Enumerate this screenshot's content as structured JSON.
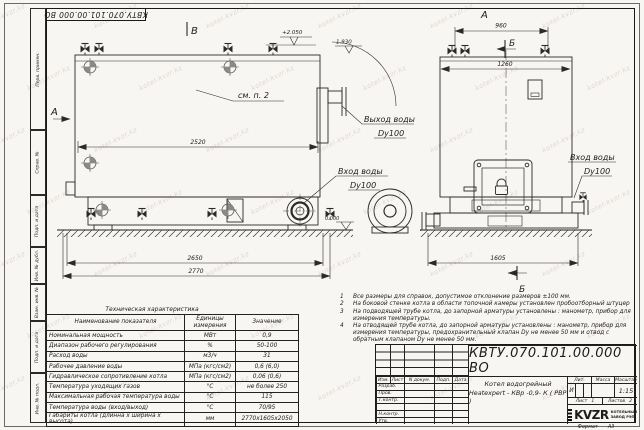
{
  "watermark": {
    "text": "kotel-kvzr.kz"
  },
  "sheet": {
    "stamp_top": "КВТУ.070.101.00.000 ВО",
    "margin_labels": [
      "Перв. примен.",
      "Справ. №",
      "Подп. и дата",
      "Инв. № дубл.",
      "Взам. инв. №",
      "Подп. и дата",
      "Инв. № подл."
    ],
    "format_label": "Формат",
    "format_value": "А3"
  },
  "views": {
    "label_v": "В",
    "label_a_side": "А",
    "label_a_top": "А",
    "label_b_top": "Б",
    "label_b_bottom": "Б",
    "see_note": "см. п. 2",
    "elev_top": "+2.050",
    "elev_outlet": "1.930",
    "elev_zero": "0.000",
    "dim_2520": "2520",
    "dim_2650": "2650",
    "dim_2770": "2770",
    "dim_960": "960",
    "dim_1260": "1260",
    "dim_1605": "1605",
    "outlet_line1": "Выход воды",
    "outlet_line2": "Dy100",
    "inlet1_line1": "Вход воды",
    "inlet1_line2": "Dy100",
    "inlet2_line1": "Вход воды",
    "inlet2_line2": "Dy100"
  },
  "tech_table": {
    "title": "Техническая характеристика",
    "headers": [
      "Наименование показателя",
      "Единицы измерения",
      "Значение"
    ],
    "rows": [
      [
        "Номинальная мощность",
        "МВт",
        "0,9"
      ],
      [
        "Диапазон рабочего регулирования",
        "%",
        "50-100"
      ],
      [
        "Расход воды",
        "м3/ч",
        "31"
      ],
      [
        "Рабочее давление воды",
        "МПа (кгс/см2)",
        "0,6 (6,0)"
      ],
      [
        "Гидравлическое сопротивление котла",
        "МПа (кгс/см2)",
        "0,06 (0,6)"
      ],
      [
        "Температура уходящих газов",
        "°С",
        "не более 250"
      ],
      [
        "Максимальная рабочая температура воды",
        "°С",
        "115"
      ],
      [
        "Температура воды (вход/выход)",
        "°С",
        "70/95"
      ],
      [
        "Габариты котла (длинна х ширина х высота)",
        "мм",
        "2770х1605х2050"
      ]
    ]
  },
  "notes": {
    "items": [
      {
        "num": "1",
        "text": "Все размеры для справок, допустимое отклонение размеров ±100 мм."
      },
      {
        "num": "2",
        "text": "На боковой стенке котла в области топочной камеры установлен пробоотборный штуцер"
      },
      {
        "num": "3",
        "text": "На  подводящей трубе котла, до запорной арматуры установлены : манометр, прибор для измерения температуры."
      },
      {
        "num": "4",
        "text": "На отводящей трубе котла, до запорной арматуры установлены : манометр, прибор для измерения температуры, предохранительный клапан  Dу не менее  50 мм и отвод с обратным клапаном  Dу не менее  50 мм."
      }
    ]
  },
  "title_block": {
    "designation": "КВТУ.070.101.00.000  ВО",
    "name_line1": "Котел водогрейный",
    "name_line2": "Heatexpert - КВр -0,9- К ( РВР )",
    "header_cols": [
      "Изм.",
      "Лист",
      "N докум.",
      "Подп.",
      "Дата"
    ],
    "sig_rows": [
      "Разраб.",
      "Пров.",
      "Т.контр.",
      "",
      "Н.контр.",
      "Утв."
    ],
    "lit_label": "Лит.",
    "mass_label": "Масса",
    "scale_label": "Масштаб",
    "lit_value": "И",
    "scale_value": "1:15",
    "sheet_label": "Лист",
    "sheet_value": "1",
    "sheets_label": "Листов",
    "sheets_value": "2",
    "logo_text": "KVZR",
    "logo_sub1": "КОТЕЛЬНЫЙ",
    "logo_sub2": "ЗАВОД РЭП"
  }
}
